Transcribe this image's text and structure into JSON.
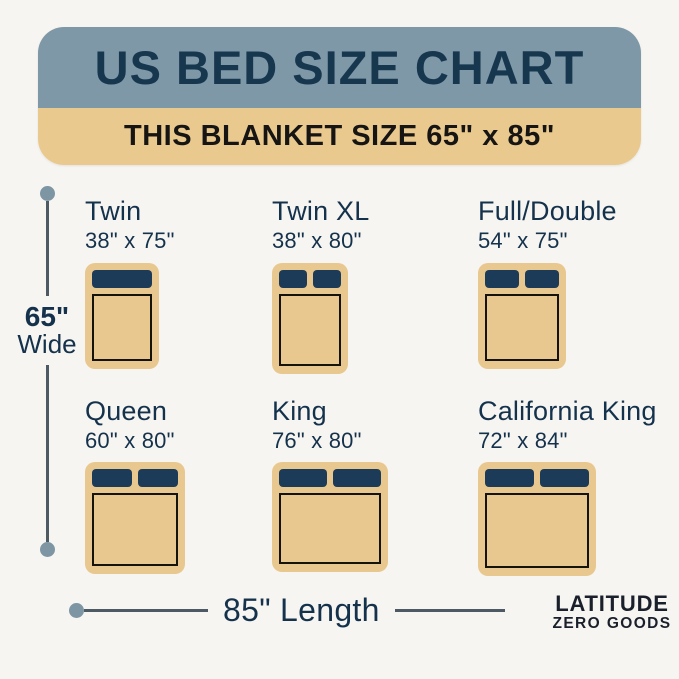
{
  "header": {
    "title": "US BED SIZE CHART",
    "subtitle": "THIS BLANKET SIZE 65\" x 85\""
  },
  "beds": [
    {
      "name": "Twin",
      "dims": "38\" x 75\"",
      "pillows": 1
    },
    {
      "name": "Twin XL",
      "dims": "38\" x 80\"",
      "pillows": 2
    },
    {
      "name": "Full/Double",
      "dims": "54\" x 75\"",
      "pillows": 2
    },
    {
      "name": "Queen",
      "dims": "60\" x 80\"",
      "pillows": 2
    },
    {
      "name": "King",
      "dims": "76\" x 80\"",
      "pillows": 2
    },
    {
      "name": "California King",
      "dims": "72\" x 84\"",
      "pillows": 2
    }
  ],
  "dimensions": {
    "width_value": "65\"",
    "width_word": "Wide",
    "length_label": "85\" Length"
  },
  "brand": {
    "line1": "LATITUDE",
    "line2": "ZERO GOODS"
  },
  "colors": {
    "background": "#f7f5f1",
    "header_bg": "#7e98a7",
    "header_text": "#17374f",
    "banner_bg": "#e9c98e",
    "banner_text": "#161513",
    "bed_base": "#e8c88e",
    "pillow": "#1c3b58",
    "sheet_outline": "#15130e",
    "label_text": "#15324c",
    "dim_line": "#4d5a64",
    "dim_dot": "#7e96a4",
    "brand_text": "#1a202b"
  }
}
